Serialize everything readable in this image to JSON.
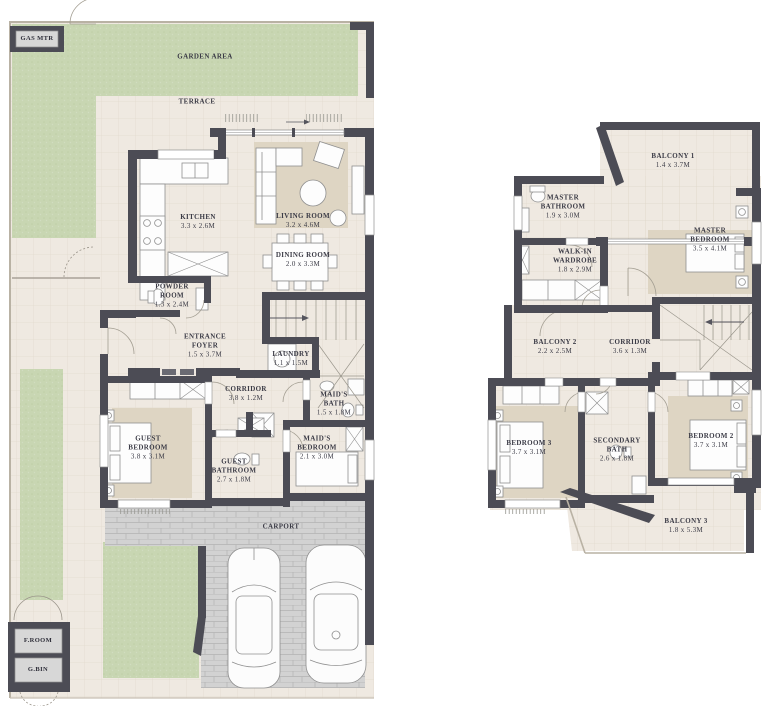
{
  "document": {
    "type": "residential floor plan",
    "floors": 2
  },
  "colors": {
    "wall": "#4c4c55",
    "floor": "#efe9e1",
    "grid_line": "#ded6c8",
    "garden": "#c8d6b2",
    "paving": "#d2d2d2",
    "rug": "#ded5c3",
    "label_text": "#3b3b46"
  },
  "floor1": {
    "rooms": [
      {
        "id": "garden-area",
        "name": "GARDEN AREA",
        "dims": ""
      },
      {
        "id": "terrace",
        "name": "TERRACE",
        "dims": ""
      },
      {
        "id": "kitchen",
        "name": "KITCHEN",
        "dims": "3.3 x 2.6M"
      },
      {
        "id": "living-room",
        "name": "LIVING ROOM",
        "dims": "3.2 x 4.6M"
      },
      {
        "id": "dining-room",
        "name": "DINING ROOM",
        "dims": "2.0 x 3.3M"
      },
      {
        "id": "powder-room",
        "name": "POWDER ROOM",
        "dims": "1.3 x 2.4M"
      },
      {
        "id": "entrance-foyer",
        "name": "ENTRANCE FOYER",
        "dims": "1.5 x 3.7M"
      },
      {
        "id": "laundry",
        "name": "LAUNDRY",
        "dims": "1.1 x 1.5M"
      },
      {
        "id": "corridor",
        "name": "CORRIDOR",
        "dims": "3.8 x 1.2M"
      },
      {
        "id": "maids-bath",
        "name": "MAID'S BATH",
        "dims": "1.5 x 1.8M"
      },
      {
        "id": "maids-bedroom",
        "name": "MAID'S BEDROOM",
        "dims": "2.1 x 3.0M"
      },
      {
        "id": "guest-bedroom",
        "name": "GUEST BEDROOM",
        "dims": "3.8 x 3.1M"
      },
      {
        "id": "guest-bathroom",
        "name": "GUEST BATHROOM",
        "dims": "2.7 x 1.8M"
      },
      {
        "id": "carport",
        "name": "CARPORT",
        "dims": ""
      }
    ],
    "utility": {
      "gas_meter": "GAS MTR",
      "f_room": "F.ROOM",
      "g_bin": "G.BIN"
    }
  },
  "floor2": {
    "rooms": [
      {
        "id": "balcony-1",
        "name": "BALCONY 1",
        "dims": "1.4 x 3.7M"
      },
      {
        "id": "master-bathroom",
        "name": "MASTER BATHROOM",
        "dims": "1.9 x 3.0M"
      },
      {
        "id": "master-bedroom",
        "name": "MASTER BEDROOM",
        "dims": "3.5 x 4.1M"
      },
      {
        "id": "walk-in-wardrobe",
        "name": "WALK-IN WARDROBE",
        "dims": "1.8 x 2.9M"
      },
      {
        "id": "balcony-2",
        "name": "BALCONY 2",
        "dims": "2.2 x 2.5M"
      },
      {
        "id": "corridor",
        "name": "CORRIDOR",
        "dims": "3.6 x 1.3M"
      },
      {
        "id": "bedroom-3",
        "name": "BEDROOM 3",
        "dims": "3.7 x 3.1M"
      },
      {
        "id": "secondary-bath",
        "name": "SECONDARY BATH",
        "dims": "2.6 x 1.8M"
      },
      {
        "id": "bedroom-2",
        "name": "BEDROOM 2",
        "dims": "3.7 x 3.1M"
      },
      {
        "id": "balcony-3",
        "name": "BALCONY 3",
        "dims": "1.8 x 5.3M"
      }
    ]
  }
}
